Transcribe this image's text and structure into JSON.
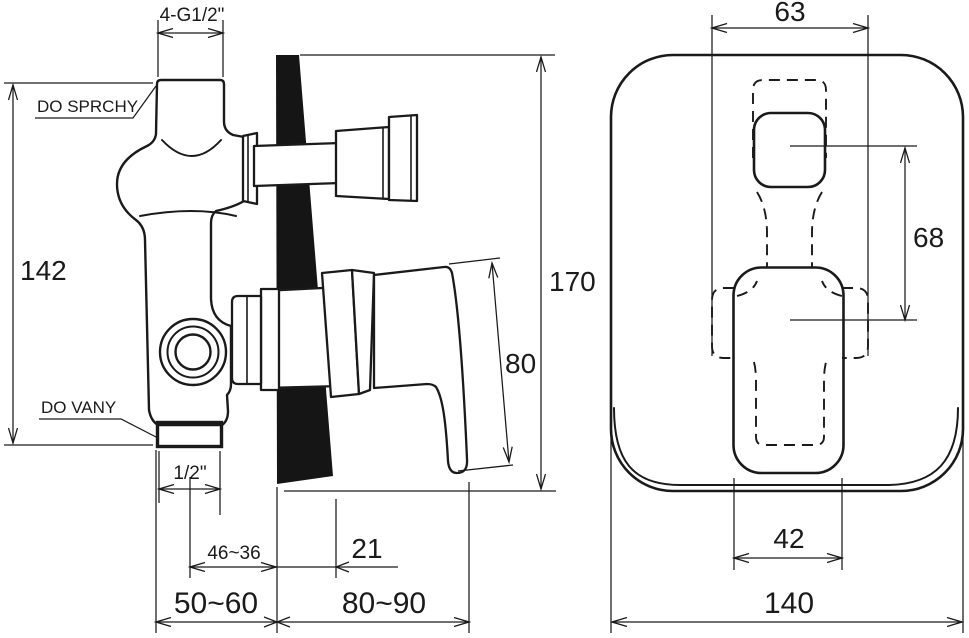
{
  "colors": {
    "ink": "#1a1a1a",
    "wall_fill": "#151515",
    "paper": "#ffffff"
  },
  "side_view": {
    "labels": {
      "thread_top": "4-G1/2\"",
      "to_shower": "DO SPRCHY",
      "to_bath": "DO VANY",
      "body_height": "142",
      "total_height": "170",
      "handle_length": "80",
      "thread_bottom": "1/2\"",
      "pipe_offset": "46~36",
      "wall_clearance": "21",
      "depth_range_left": "50~60",
      "depth_range_right": "80~90"
    }
  },
  "front_view": {
    "labels": {
      "cutout_width": "63",
      "center_distance": "68",
      "lever_width": "42",
      "plate_width": "140"
    }
  }
}
